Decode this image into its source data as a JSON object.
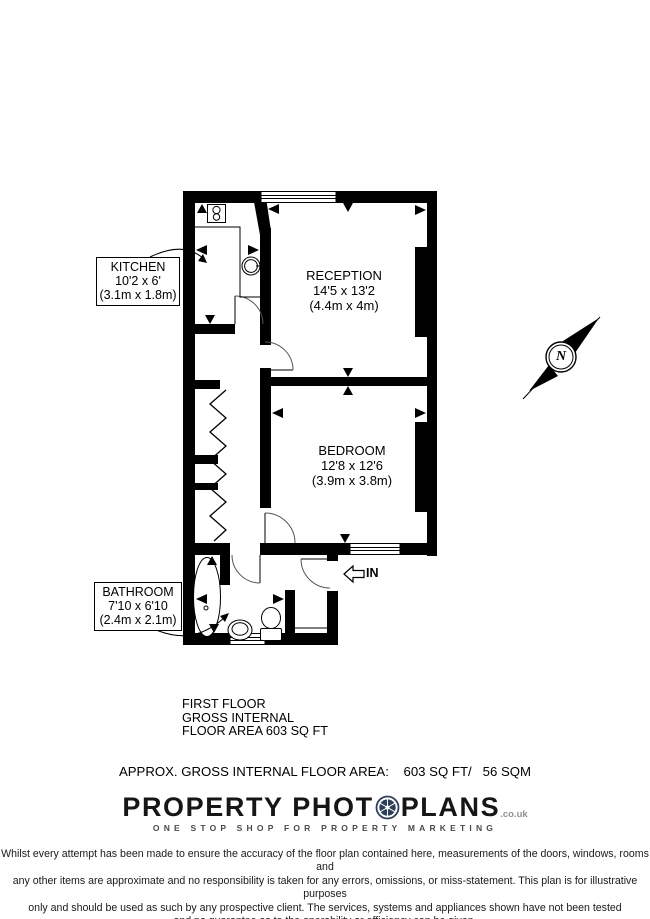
{
  "floorplan": {
    "rooms": [
      {
        "name": "KITCHEN",
        "size_imperial": "10'2 x 6'",
        "size_metric": "(3.1m x 1.8m)"
      },
      {
        "name": "RECEPTION",
        "size_imperial": "14'5 x 13'2",
        "size_metric": "(4.4m x 4m)"
      },
      {
        "name": "BEDROOM",
        "size_imperial": "12'8 x 12'6",
        "size_metric": "(3.9m x 3.8m)"
      },
      {
        "name": "BATHROOM",
        "size_imperial": "7'10 x 6'10",
        "size_metric": "(2.4m x 2.1m)"
      }
    ],
    "entrance_label": "IN",
    "compass_label": "N"
  },
  "area_summary": {
    "floor": "FIRST FLOOR",
    "basis": "GROSS INTERNAL",
    "area": "FLOOR AREA 603 SQ FT",
    "approx": "APPROX. GROSS INTERNAL FLOOR AREA:    603 SQ FT/   56 SQM"
  },
  "branding": {
    "name_left": "PROPERTY PHOT",
    "name_right": "PLANS",
    "domain": ".co.uk",
    "tagline": "ONE STOP SHOP FOR PROPERTY MARKETING"
  },
  "disclaimer": {
    "line1": "Whilst every attempt has been made to ensure the accuracy of the floor plan contained here, measurements of the doors, windows, rooms and",
    "line2": "any other items are approximate and no responsibility is taken for any errors, omissions, or miss-statement. This plan is for illustrative purposes",
    "line3": "only and should be used as such by any prospective client. The services, systems and appliances shown have not been tested",
    "line4": "and no guarantee as to the operability or efficiency can be given."
  },
  "colors": {
    "walls": "#000000",
    "lens_blue": "#2e3f57"
  }
}
